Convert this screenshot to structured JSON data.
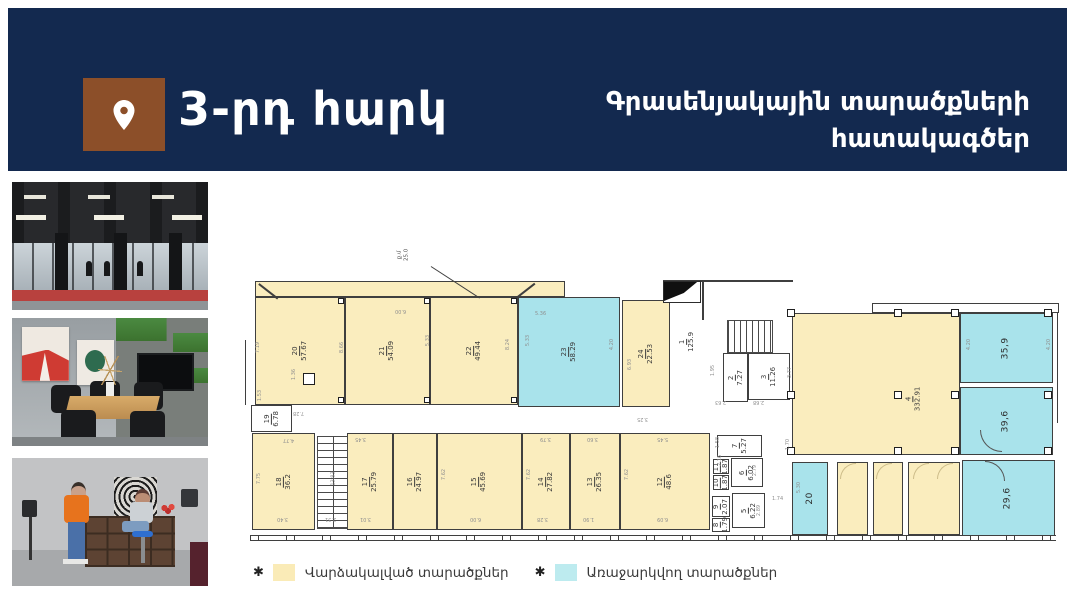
{
  "header": {
    "title": "3-րդ հարկ",
    "subtitle_line1": "Գրասենյակային տարածքների",
    "subtitle_line2": "հատակագծեր"
  },
  "colors": {
    "navy": "#13294F",
    "brown": "#8C4F29",
    "leased_fill": "#FAEDBE",
    "offered_fill": "#A9E3EB",
    "wall": "#3F3F3F"
  },
  "legend": {
    "items": [
      {
        "marker": "✱",
        "color": "#FAEBB7",
        "label": "Վարձակալված տարածքներ"
      },
      {
        "marker": "✱",
        "color": "#BDEBEF",
        "label": "Առաջարկվող տարածքներ"
      }
    ]
  },
  "photos": [
    {
      "name": "photo-event-hall"
    },
    {
      "name": "photo-meeting-room"
    },
    {
      "name": "photo-workspace"
    }
  ],
  "floorplan": {
    "callout": {
      "line1": "ք.մ",
      "line2": "25.0"
    },
    "rooms": [
      {
        "f": "y",
        "x": 10,
        "y": 31,
        "w": 310,
        "h": 16
      },
      {
        "n": "20",
        "a": "57.67",
        "f": "y",
        "x": 10,
        "y": 47,
        "w": 90,
        "h": 108
      },
      {
        "n": "21",
        "a": "54.09",
        "f": "y",
        "x": 100,
        "y": 47,
        "w": 85,
        "h": 108
      },
      {
        "n": "22",
        "a": "49.44",
        "f": "y",
        "x": 185,
        "y": 47,
        "w": 88,
        "h": 108
      },
      {
        "n": "23",
        "a": "58.29",
        "f": "c",
        "x": 273,
        "y": 47,
        "w": 102,
        "h": 110
      },
      {
        "n": "24",
        "a": "22.53",
        "f": "y",
        "x": 377,
        "y": 50,
        "w": 48,
        "h": 107
      },
      {
        "n": "1",
        "a": "125.9",
        "f": "n",
        "nb": 1,
        "x": 430,
        "y": 70,
        "w": 24,
        "h": 44
      },
      {
        "n": "2",
        "a": "7.27",
        "f": "w",
        "x": 478,
        "y": 103,
        "w": 25,
        "h": 49
      },
      {
        "n": "3",
        "a": "11.26",
        "f": "w",
        "x": 503,
        "y": 103,
        "w": 42,
        "h": 47
      },
      {
        "n": "4",
        "a": "332.91",
        "f": "y",
        "x": 547,
        "y": 63,
        "w": 168,
        "h": 142,
        "lx": 108,
        "ly": 76
      },
      {
        "a": "35,9",
        "f": "c",
        "big": 1,
        "x": 715,
        "y": 63,
        "w": 93,
        "h": 70
      },
      {
        "a": "39,6",
        "f": "c",
        "big": 1,
        "x": 715,
        "y": 137,
        "w": 93,
        "h": 68
      },
      {
        "n": "19",
        "a": "6.78",
        "f": "w",
        "x": 6,
        "y": 155,
        "w": 41,
        "h": 27
      },
      {
        "n": "18",
        "a": "36.2",
        "f": "y",
        "x": 7,
        "y": 183,
        "w": 63,
        "h": 97
      },
      {
        "n": "17",
        "a": "25.79",
        "f": "y",
        "x": 102,
        "y": 183,
        "w": 46,
        "h": 97
      },
      {
        "n": "16",
        "a": "24.97",
        "f": "y",
        "x": 148,
        "y": 183,
        "w": 44,
        "h": 97
      },
      {
        "n": "15",
        "a": "45.69",
        "f": "y",
        "x": 192,
        "y": 183,
        "w": 85,
        "h": 97
      },
      {
        "n": "14",
        "a": "27.82",
        "f": "y",
        "x": 277,
        "y": 183,
        "w": 48,
        "h": 97
      },
      {
        "n": "13",
        "a": "26.35",
        "f": "y",
        "x": 325,
        "y": 183,
        "w": 50,
        "h": 97
      },
      {
        "n": "12",
        "a": "48.6",
        "f": "y",
        "x": 375,
        "y": 183,
        "w": 90,
        "h": 97
      },
      {
        "n": "7",
        "a": "5.27",
        "f": "w",
        "x": 472,
        "y": 185,
        "w": 45,
        "h": 22
      },
      {
        "n": "11",
        "a": "1.87",
        "f": "w",
        "x": 468,
        "y": 209,
        "w": 16,
        "h": 15
      },
      {
        "n": "6",
        "a": "6.02",
        "f": "w",
        "x": 486,
        "y": 208,
        "w": 32,
        "h": 29
      },
      {
        "n": "10",
        "a": "1.87",
        "f": "w",
        "x": 468,
        "y": 225,
        "w": 16,
        "h": 15
      },
      {
        "n": "9",
        "a": "2.07",
        "f": "w",
        "x": 467,
        "y": 246,
        "w": 18,
        "h": 21
      },
      {
        "n": "5",
        "a": "6.22",
        "f": "w",
        "x": 487,
        "y": 243,
        "w": 33,
        "h": 35
      },
      {
        "n": "8",
        "a": "1.79",
        "f": "w",
        "x": 467,
        "y": 268,
        "w": 18,
        "h": 14
      },
      {
        "a": "20",
        "f": "c",
        "big": 1,
        "x": 547,
        "y": 212,
        "w": 36,
        "h": 73
      },
      {
        "f": "y",
        "x": 592,
        "y": 212,
        "w": 31,
        "h": 73
      },
      {
        "f": "y",
        "x": 628,
        "y": 212,
        "w": 30,
        "h": 73
      },
      {
        "f": "y",
        "x": 663,
        "y": 212,
        "w": 52,
        "h": 73
      },
      {
        "a": "29,6",
        "f": "c",
        "big": 1,
        "x": 717,
        "y": 210,
        "w": 93,
        "h": 77
      }
    ],
    "walls": [
      {
        "x": 418,
        "y": 30,
        "w": 130,
        "h": 2
      },
      {
        "x": 457,
        "y": 30,
        "w": 2,
        "h": 40
      },
      {
        "x": 0,
        "y": 90,
        "w": 1,
        "h": 65
      },
      {
        "x": 812,
        "y": 53,
        "w": 1,
        "h": 120
      },
      {
        "x": 5,
        "y": 285,
        "w": 806,
        "h": 6,
        "win": 1
      },
      {
        "x": 627,
        "y": 53,
        "w": 187,
        "h": 10,
        "open": 1
      },
      {
        "x": 14,
        "y": 33,
        "w": 24,
        "h": 1.5,
        "rot": 38
      },
      {
        "x": 290,
        "y": 33,
        "w": 24,
        "h": 1.5,
        "rot": 142
      },
      {
        "x": 186,
        "y": 16,
        "w": 58,
        "h": 1,
        "rot": 33,
        "name": "callout-leader"
      }
    ],
    "columns": [
      {
        "x": 542,
        "y": 59
      },
      {
        "x": 649,
        "y": 59
      },
      {
        "x": 706,
        "y": 59
      },
      {
        "x": 542,
        "y": 141
      },
      {
        "x": 649,
        "y": 141
      },
      {
        "x": 706,
        "y": 141
      },
      {
        "x": 542,
        "y": 197
      },
      {
        "x": 649,
        "y": 197
      },
      {
        "x": 706,
        "y": 197
      },
      {
        "x": 799,
        "y": 59
      },
      {
        "x": 799,
        "y": 141
      },
      {
        "x": 799,
        "y": 197
      },
      {
        "x": 93,
        "y": 48,
        "s": 6
      },
      {
        "x": 179,
        "y": 48,
        "s": 6
      },
      {
        "x": 266,
        "y": 48,
        "s": 6
      },
      {
        "x": 93,
        "y": 147,
        "s": 6
      },
      {
        "x": 179,
        "y": 147,
        "s": 6
      },
      {
        "x": 266,
        "y": 147,
        "s": 6
      },
      {
        "x": 58,
        "y": 123,
        "s": 12
      }
    ],
    "stairs": [
      {
        "x": 482,
        "y": 70,
        "w": 46,
        "h": 33,
        "dir": "h"
      },
      {
        "x": 72,
        "y": 186,
        "w": 31,
        "h": 93,
        "dir": "v"
      }
    ],
    "arcs": [
      {
        "x": 735,
        "y": 180,
        "s": 22,
        "q": "bl"
      },
      {
        "x": 740,
        "y": 211,
        "s": 20,
        "q": "tr"
      },
      {
        "x": 595,
        "y": 213,
        "s": 16,
        "q": "tl",
        "light": 1
      },
      {
        "x": 631,
        "y": 213,
        "s": 16,
        "q": "tl",
        "light": 1
      },
      {
        "x": 668,
        "y": 213,
        "s": 16,
        "q": "tl",
        "light": 1
      },
      {
        "x": 692,
        "y": 213,
        "s": 16,
        "q": "tl",
        "light": 1
      }
    ],
    "wedge": {
      "x": 418,
      "y": 31,
      "w": 38,
      "h": 22
    },
    "dims": [
      {
        "t": "6.00",
        "x": 150,
        "y": 58,
        "r": 180
      },
      {
        "t": "7.19",
        "x": 8,
        "y": 95,
        "r": -90
      },
      {
        "t": "8.66",
        "x": 92,
        "y": 95,
        "r": -90
      },
      {
        "t": "5.33",
        "x": 178,
        "y": 88,
        "r": -90
      },
      {
        "t": "8.24",
        "x": 258,
        "y": 92,
        "r": -90
      },
      {
        "t": "5.33",
        "x": 278,
        "y": 88,
        "r": -90
      },
      {
        "t": "5.36",
        "x": 290,
        "y": 62,
        "r": 0
      },
      {
        "t": "4.20",
        "x": 362,
        "y": 92,
        "r": -90
      },
      {
        "t": "6.93",
        "x": 380,
        "y": 112,
        "r": -90
      },
      {
        "t": "3.25",
        "x": 392,
        "y": 166,
        "r": 180
      },
      {
        "t": "1.53",
        "x": 10,
        "y": 143,
        "r": -90
      },
      {
        "t": "1.36",
        "x": 44,
        "y": 122,
        "r": -90
      },
      {
        "t": "7.28",
        "x": 48,
        "y": 160,
        "r": 180
      },
      {
        "t": "4.77",
        "x": 38,
        "y": 187,
        "r": 180
      },
      {
        "t": "7.75",
        "x": 9,
        "y": 226,
        "r": -90
      },
      {
        "t": "3.40",
        "x": 32,
        "y": 266,
        "r": 180
      },
      {
        "t": "2.31",
        "x": 80,
        "y": 266,
        "r": 180
      },
      {
        "t": "3.01",
        "x": 115,
        "y": 266,
        "r": 180
      },
      {
        "t": "3.45",
        "x": 110,
        "y": 186,
        "r": 180
      },
      {
        "t": "6.00",
        "x": 225,
        "y": 266,
        "r": 180
      },
      {
        "t": "7.62",
        "x": 194,
        "y": 222,
        "r": -90
      },
      {
        "t": "3.28",
        "x": 292,
        "y": 266,
        "r": 180
      },
      {
        "t": "1.90",
        "x": 338,
        "y": 266,
        "r": 180
      },
      {
        "t": "6.09",
        "x": 412,
        "y": 266,
        "r": 180
      },
      {
        "t": "5.45",
        "x": 412,
        "y": 186,
        "r": 180
      },
      {
        "t": "3.60",
        "x": 342,
        "y": 186,
        "r": 180
      },
      {
        "t": "3.79",
        "x": 295,
        "y": 186,
        "r": 180
      },
      {
        "t": "7.62",
        "x": 279,
        "y": 222,
        "r": -90
      },
      {
        "t": "7.62",
        "x": 377,
        "y": 222,
        "r": -90
      },
      {
        "t": "13.83",
        "x": 82,
        "y": 226,
        "r": -90
      },
      {
        "t": "5.30",
        "x": 549,
        "y": 235,
        "r": -90
      },
      {
        "t": "1.70",
        "x": 538,
        "y": 192,
        "r": -90
      },
      {
        "t": "4.20",
        "x": 719,
        "y": 92,
        "r": -90
      },
      {
        "t": "4.20",
        "x": 799,
        "y": 92,
        "r": -90
      },
      {
        "t": "1.74",
        "x": 527,
        "y": 247,
        "r": 0
      },
      {
        "t": "2.16",
        "x": 470,
        "y": 208,
        "r": -90
      },
      {
        "t": "2.79",
        "x": 505,
        "y": 218,
        "r": -90
      },
      {
        "t": "2.89",
        "x": 509,
        "y": 258,
        "r": -90
      },
      {
        "t": "1.58",
        "x": 468,
        "y": 190,
        "r": -90
      },
      {
        "t": "1.95",
        "x": 463,
        "y": 118,
        "r": -90
      },
      {
        "t": "2.63",
        "x": 470,
        "y": 149,
        "r": 180
      },
      {
        "t": "2.68",
        "x": 508,
        "y": 149,
        "r": 180
      },
      {
        "t": "3.77",
        "x": 540,
        "y": 120,
        "r": -90
      }
    ]
  }
}
